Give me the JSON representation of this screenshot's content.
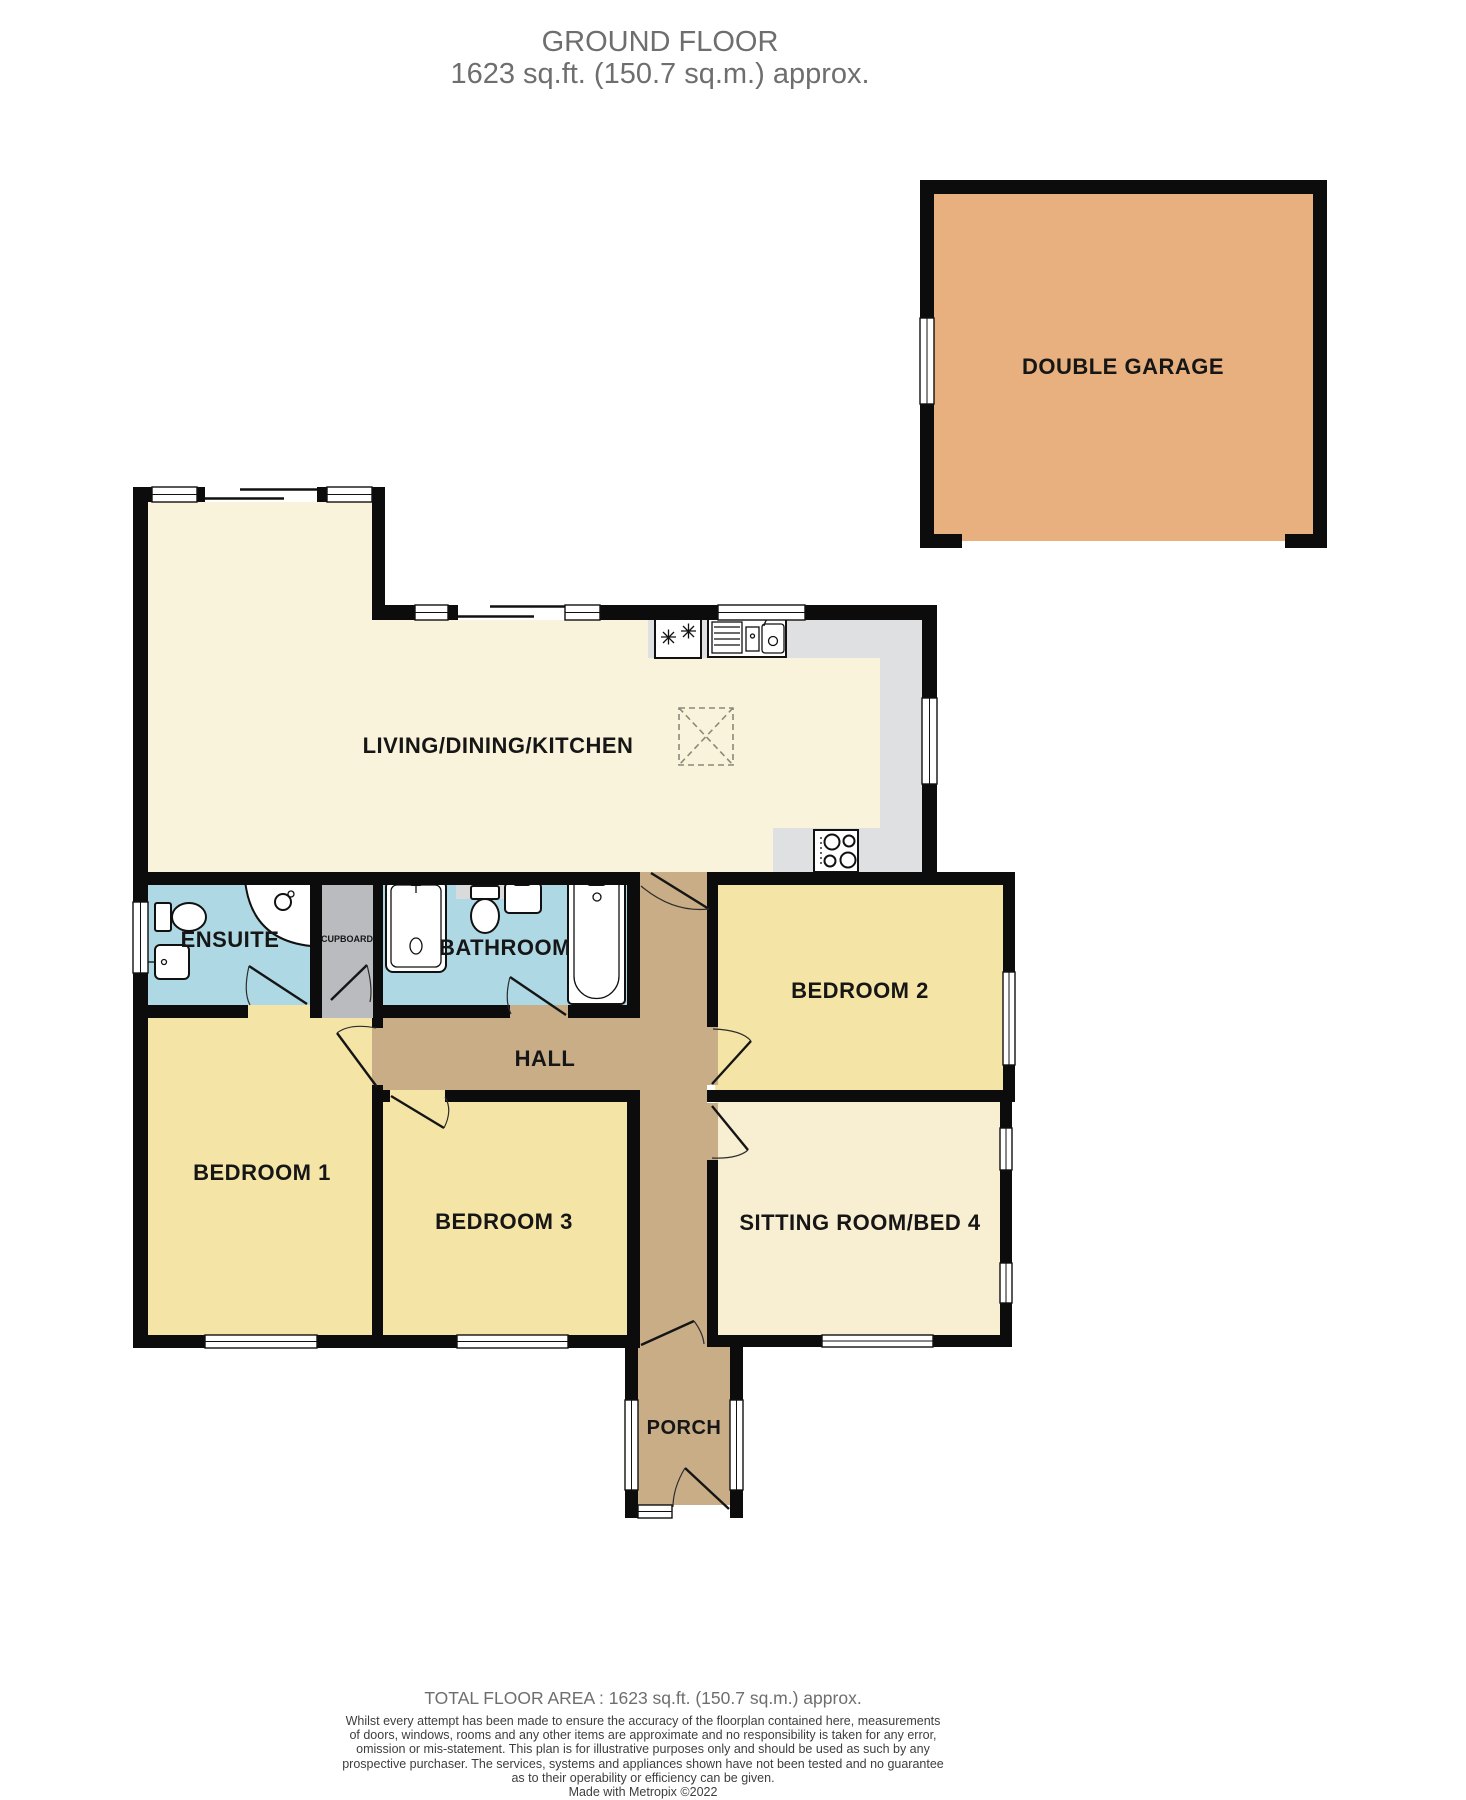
{
  "title": {
    "line1": "GROUND FLOOR",
    "line2": "1623 sq.ft. (150.7 sq.m.) approx."
  },
  "rooms": {
    "garage": {
      "label": "DOUBLE GARAGE"
    },
    "living": {
      "label": "LIVING/DINING/KITCHEN"
    },
    "ensuite": {
      "label": "ENSUITE"
    },
    "cupboard": {
      "label": "CUPBOARD"
    },
    "bathroom": {
      "label": "BATHROOM"
    },
    "hall": {
      "label": "HALL"
    },
    "bedroom1": {
      "label": "BEDROOM 1"
    },
    "bedroom2": {
      "label": "BEDROOM 2"
    },
    "bedroom3": {
      "label": "BEDROOM 3"
    },
    "sitting": {
      "label": "SITTING ROOM/BED 4"
    },
    "porch": {
      "label": "PORCH"
    }
  },
  "icons": [
    "toilet-icon",
    "corner-shower-icon",
    "hand-basin-icon",
    "shower-tray-icon",
    "bathtub-icon",
    "fridge-freezer-icon",
    "kitchen-sink-icon",
    "hob-icon",
    "skylight-icon",
    "door-swing-icon",
    "window",
    "sliding-door-icon"
  ],
  "colors": {
    "wall": "#0c0c0c",
    "garage": "#e8b07e",
    "living": "#faf3db",
    "bedroom": "#f4e5a6",
    "sitting": "#f8efd2",
    "hall": "#c8ad87",
    "bath": "#aed8e3",
    "cupboard": "#b9bbbf",
    "counter": "#dfe0e2",
    "title_text": "#6e6e6e",
    "label_text": "#161616"
  },
  "footer": {
    "total_area": "TOTAL FLOOR AREA : 1623 sq.ft. (150.7 sq.m.) approx.",
    "disclaimer_lines": [
      "Whilst every attempt has been made to ensure the accuracy of the floorplan contained here, measurements",
      "of doors, windows, rooms and any other items are approximate and no responsibility is taken for any error,",
      "omission or mis-statement. This plan is for illustrative purposes only and should be used as such by any",
      "prospective purchaser. The services, systems and appliances shown have not been tested and no guarantee",
      "as to their operability or efficiency can be given."
    ],
    "credit": "Made with Metropix ©2022"
  }
}
